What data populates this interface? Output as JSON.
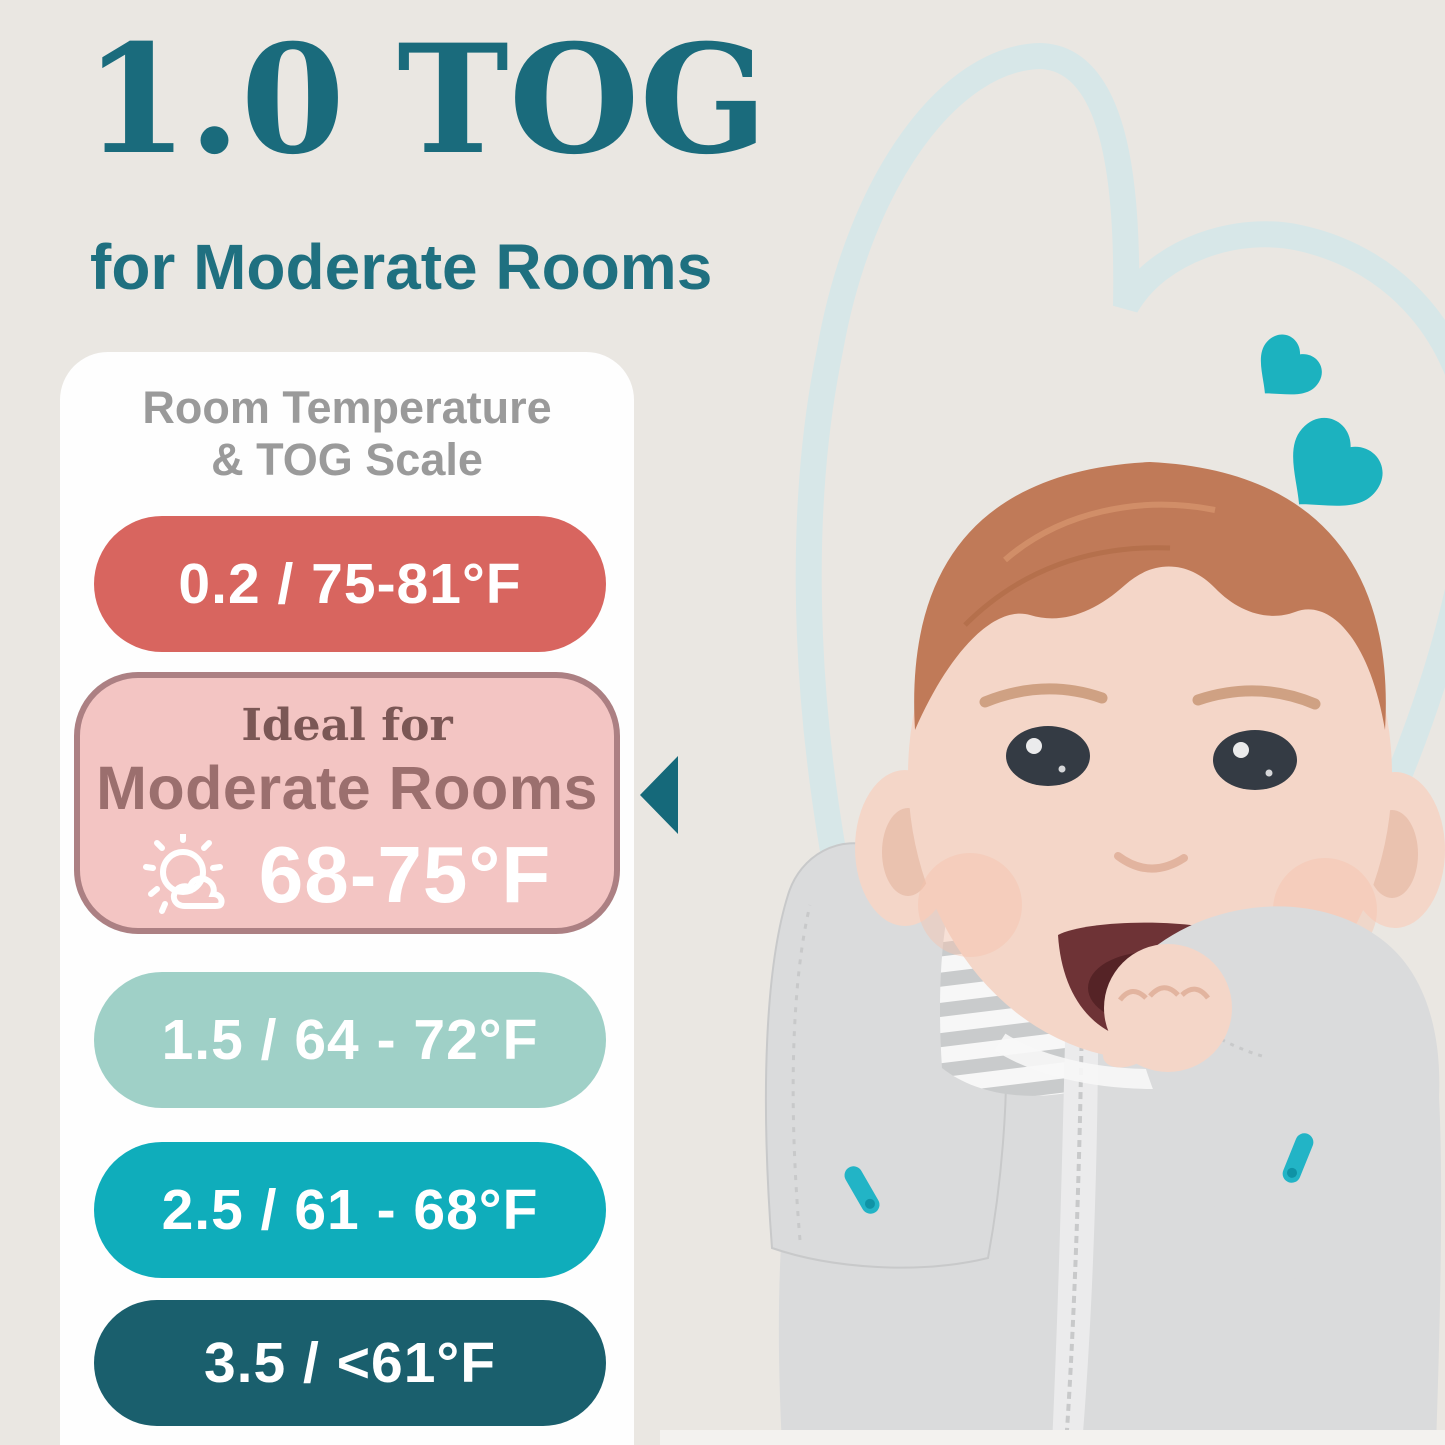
{
  "page": {
    "background": "#eae7e2",
    "card_background": "#fefefe"
  },
  "header": {
    "title": "1.0 TOG",
    "title_color": "#1a6b7c",
    "subtitle": "for Moderate Rooms",
    "subtitle_color": "#1f7080"
  },
  "scale_card": {
    "heading_line1": "Room Temperature",
    "heading_line2": "& TOG Scale",
    "heading_color": "#9a9a9a",
    "rows": [
      {
        "type": "simple",
        "label": "0.2 / 75-81°F",
        "bg": "#d8655f",
        "text_color": "#ffffff"
      },
      {
        "type": "ideal",
        "intro": "Ideal for",
        "room": "Moderate Rooms",
        "temp": "68-75°F",
        "bg": "#f3c5c3",
        "border": "#ac8083",
        "intro_color": "#7b5755",
        "room_color": "#9b6f6e",
        "temp_color": "#ffffff",
        "icon": "sun-behind-cloud-icon",
        "icon_color": "#ffffff"
      },
      {
        "type": "simple",
        "label": "1.5 / 64 - 72°F",
        "bg": "#9fd0c7",
        "text_color": "#ffffff"
      },
      {
        "type": "simple",
        "label": "2.5 / 61 - 68°F",
        "bg": "#0fadbb",
        "text_color": "#ffffff"
      },
      {
        "type": "simple",
        "label": "3.5 / <61°F",
        "bg": "#1a5f6d",
        "text_color": "#ffffff"
      }
    ],
    "pointer_color": "#15697a"
  },
  "illustration": {
    "description": "Smiling baby lying down wearing a gray arms-up transition swaddle with striped chest panel, center zipper and teal zipper pulls; decorative teal hearts and a light heart outline in the background",
    "heart_outline_color": "#d7e7e8",
    "heart_accent_color": "#1cb2bf",
    "skin_color": "#f4d6c8",
    "skin_shadow_color": "#e2b49f",
    "hair_color": "#c07a58",
    "eye_color": "#343b44",
    "mouth_color": "#6e3336",
    "swaddle_gray": "#dadbdc",
    "swaddle_edge": "#c8c9ca",
    "stripe_gray": "#c9cbcc",
    "stripe_white": "#f7f7f7",
    "zipper_tape": "#ebebec",
    "zipper_pull_color": "#22b4c6",
    "zipper_pull_edge": "#0f93a6",
    "bottom_band": "#f3f2ef"
  }
}
